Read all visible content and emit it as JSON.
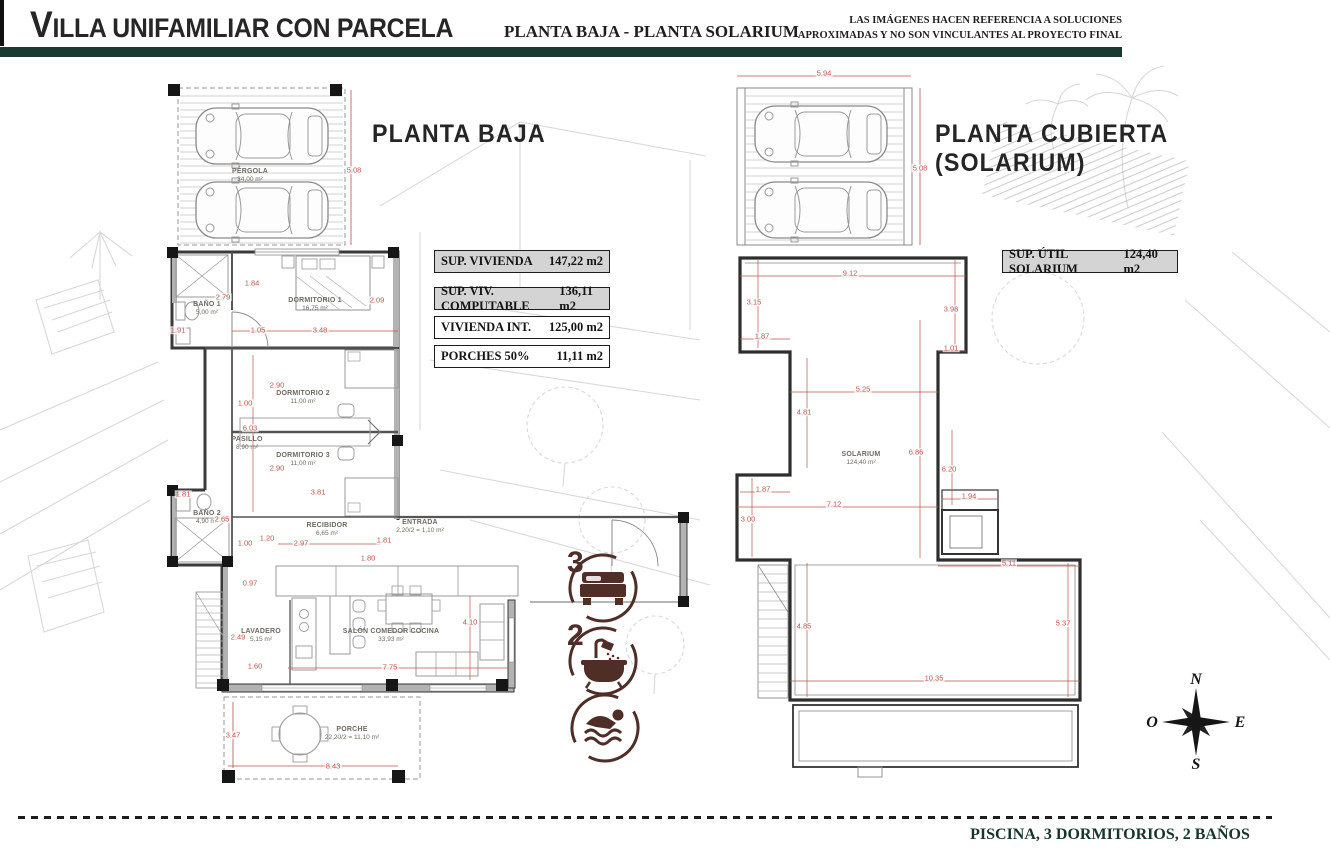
{
  "header": {
    "title": "VILLA UNIFAMILIAR CON PARCELA",
    "subtitle": "PLANTA BAJA - PLANTA SOLARIUM",
    "disclaimer_line1": "LAS IMÁGENES HACEN REFERENCIA A SOLUCIONES",
    "disclaimer_line2": "APROXIMADAS Y NO SON VINCULANTES AL PROYECTO FINAL"
  },
  "left_plan": {
    "title": "PLANTA BAJA",
    "rooms": [
      {
        "name": "PÉRGOLA",
        "area": "34,00 m²",
        "x": 250,
        "y": 176
      },
      {
        "name": "BAÑO 1",
        "area": "5,00 m²",
        "x": 207,
        "y": 309
      },
      {
        "name": "DORMITORIO 1",
        "area": "16,75 m²",
        "x": 315,
        "y": 305
      },
      {
        "name": "DORMITORIO 2",
        "area": "11,00 m²",
        "x": 303,
        "y": 398
      },
      {
        "name": "PASILLO",
        "area": "8,90 m²",
        "x": 247,
        "y": 444
      },
      {
        "name": "DORMITORIO 3",
        "area": "11,00 m²",
        "x": 303,
        "y": 460
      },
      {
        "name": "BAÑO 2",
        "area": "4,90 m²",
        "x": 207,
        "y": 518
      },
      {
        "name": "RECIBIDOR",
        "area": "6,65 m²",
        "x": 327,
        "y": 530
      },
      {
        "name": "ENTRADA",
        "area": "2,20/2 = 1,10 m²",
        "x": 420,
        "y": 527
      },
      {
        "name": "LAVADERO",
        "area": "5,15 m²",
        "x": 261,
        "y": 636
      },
      {
        "name": "SALÓN COMEDOR COCINA",
        "area": "33,93 m²",
        "x": 391,
        "y": 636
      },
      {
        "name": "PORCHE",
        "area": "22,20/2 = 11,10 m²",
        "x": 352,
        "y": 734
      }
    ],
    "dimensions": [
      {
        "t": "5.08",
        "x": 354,
        "y": 170
      },
      {
        "t": "1.84",
        "x": 252,
        "y": 283
      },
      {
        "t": "2.79",
        "x": 223,
        "y": 297
      },
      {
        "t": "2.09",
        "x": 377,
        "y": 300
      },
      {
        "t": "1.91",
        "x": 178,
        "y": 330
      },
      {
        "t": "1.05",
        "x": 258,
        "y": 330
      },
      {
        "t": "3.48",
        "x": 320,
        "y": 330
      },
      {
        "t": "1.00",
        "x": 245,
        "y": 403
      },
      {
        "t": "2.90",
        "x": 277,
        "y": 385
      },
      {
        "t": "6.03",
        "x": 250,
        "y": 428
      },
      {
        "t": "2.90",
        "x": 277,
        "y": 468
      },
      {
        "t": "1.81",
        "x": 183,
        "y": 494
      },
      {
        "t": "3.81",
        "x": 318,
        "y": 492
      },
      {
        "t": "2.65",
        "x": 222,
        "y": 519
      },
      {
        "t": "1.20",
        "x": 267,
        "y": 538
      },
      {
        "t": "1.00",
        "x": 245,
        "y": 543
      },
      {
        "t": "2.97",
        "x": 301,
        "y": 543
      },
      {
        "t": "1.81",
        "x": 384,
        "y": 540
      },
      {
        "t": "1.80",
        "x": 368,
        "y": 558
      },
      {
        "t": "0.97",
        "x": 250,
        "y": 583
      },
      {
        "t": "2.49",
        "x": 238,
        "y": 637
      },
      {
        "t": "4.10",
        "x": 470,
        "y": 622
      },
      {
        "t": "1.60",
        "x": 255,
        "y": 666
      },
      {
        "t": "7.75",
        "x": 390,
        "y": 667
      },
      {
        "t": "3.47",
        "x": 233,
        "y": 735
      },
      {
        "t": "8.43",
        "x": 333,
        "y": 766
      }
    ],
    "surface_table": [
      {
        "label": "SUP. VIVIENDA",
        "value": "147,22 m2",
        "shaded": true,
        "gap": true
      },
      {
        "label": "SUP. VIV. COMPUTABLE",
        "value": "136,11 m2",
        "shaded": true,
        "gap": false
      },
      {
        "label": "VIVIENDA INT.",
        "value": "125,00 m2",
        "shaded": false,
        "gap": false
      },
      {
        "label": "PORCHES 50%",
        "value": "11,11 m2",
        "shaded": false,
        "gap": false
      }
    ],
    "features": [
      {
        "count": "3",
        "icon": "bed-icon"
      },
      {
        "count": "2",
        "icon": "bath-icon"
      },
      {
        "count": "",
        "icon": "swimmer-icon"
      }
    ]
  },
  "right_plan": {
    "title_line1": "PLANTA CUBIERTA",
    "title_line2": "(SOLARIUM)",
    "surface_table": [
      {
        "label": "SUP. ÚTIL SOLARIUM",
        "value": "124,40 m2",
        "shaded": true,
        "gap": false
      }
    ],
    "room": {
      "name": "SOLARIUM",
      "area": "124,40 m²",
      "x": 861,
      "y": 459
    },
    "dimensions": [
      {
        "t": "5.94",
        "x": 824,
        "y": 73
      },
      {
        "t": "5.08",
        "x": 920,
        "y": 168
      },
      {
        "t": "9.12",
        "x": 850,
        "y": 273
      },
      {
        "t": "3.15",
        "x": 754,
        "y": 302
      },
      {
        "t": "3.98",
        "x": 951,
        "y": 309
      },
      {
        "t": "1.87",
        "x": 762,
        "y": 336
      },
      {
        "t": "1.01",
        "x": 951,
        "y": 348
      },
      {
        "t": "5.25",
        "x": 863,
        "y": 389
      },
      {
        "t": "4.81",
        "x": 804,
        "y": 412
      },
      {
        "t": "6.86",
        "x": 916,
        "y": 452
      },
      {
        "t": "6.20",
        "x": 949,
        "y": 469
      },
      {
        "t": "1.87",
        "x": 763,
        "y": 489
      },
      {
        "t": "7.12",
        "x": 834,
        "y": 504
      },
      {
        "t": "3.00",
        "x": 748,
        "y": 519
      },
      {
        "t": "1.94",
        "x": 969,
        "y": 496
      },
      {
        "t": "5.11",
        "x": 1009,
        "y": 563
      },
      {
        "t": "4.85",
        "x": 804,
        "y": 626
      },
      {
        "t": "5.37",
        "x": 1063,
        "y": 623
      },
      {
        "t": "10.35",
        "x": 934,
        "y": 678
      }
    ]
  },
  "compass": {
    "n": "N",
    "e": "E",
    "s": "S",
    "w": "O"
  },
  "footer": {
    "text": "PISCINA, 3 DORMITORIOS, 2 BAÑOS"
  },
  "colors": {
    "accent_green": "#1a3a31",
    "dimension_red": "#b4584b",
    "icon_brown": "#4f2e27"
  }
}
